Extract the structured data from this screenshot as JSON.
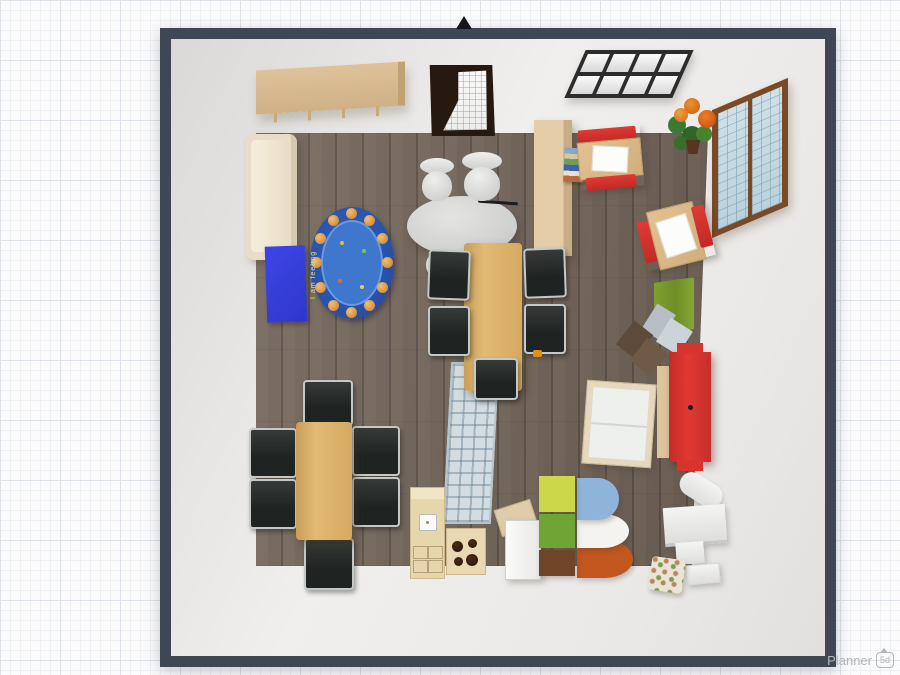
{
  "app": {
    "watermark_brand": "Planner",
    "watermark_badge": "5d"
  },
  "scene": {
    "view": "top-down 3D floor plan of a classroom/playroom",
    "rug_text": "I am feeling",
    "palette": {
      "wall_outline": "#3f4654",
      "wall_interior": "#edeae8",
      "floor_wood": "#72655a",
      "accent_red_sofa": "#d93330",
      "emotions_rug_blue": "#3f77cc",
      "play_mat_blue": "#3d45e8",
      "rug_green": "#7aa02f",
      "wood_furniture": "#d9b270",
      "desk_chair_red": "#d2302c"
    },
    "objects": [
      {
        "label": "wall shelf / coat rack"
      },
      {
        "label": "dark glass door"
      },
      {
        "label": "flat grid window panel"
      },
      {
        "label": "wall window with blue panes"
      },
      {
        "label": "flower pot"
      },
      {
        "label": "cream sofa"
      },
      {
        "label": "blue play mat"
      },
      {
        "label": "oval emotions rug"
      },
      {
        "label": "gray oval table with two vases"
      },
      {
        "label": "tall beige cabinet"
      },
      {
        "label": "stack of books"
      },
      {
        "label": "school desk with red chairs (x2)"
      },
      {
        "label": "green rug"
      },
      {
        "label": "brown folding chair"
      },
      {
        "label": "gray folding chair"
      },
      {
        "label": "crib / changing table"
      },
      {
        "label": "red sofa"
      },
      {
        "label": "colorful curved toy shelf"
      },
      {
        "label": "kitchen cabinet with sink"
      },
      {
        "label": "stove with burners"
      },
      {
        "label": "fridge with open door"
      },
      {
        "label": "plaid runner rug"
      },
      {
        "label": "wooden dining table with black chrome chairs (x2)"
      },
      {
        "label": "white piano with bench"
      },
      {
        "label": "floral pouf"
      }
    ]
  }
}
